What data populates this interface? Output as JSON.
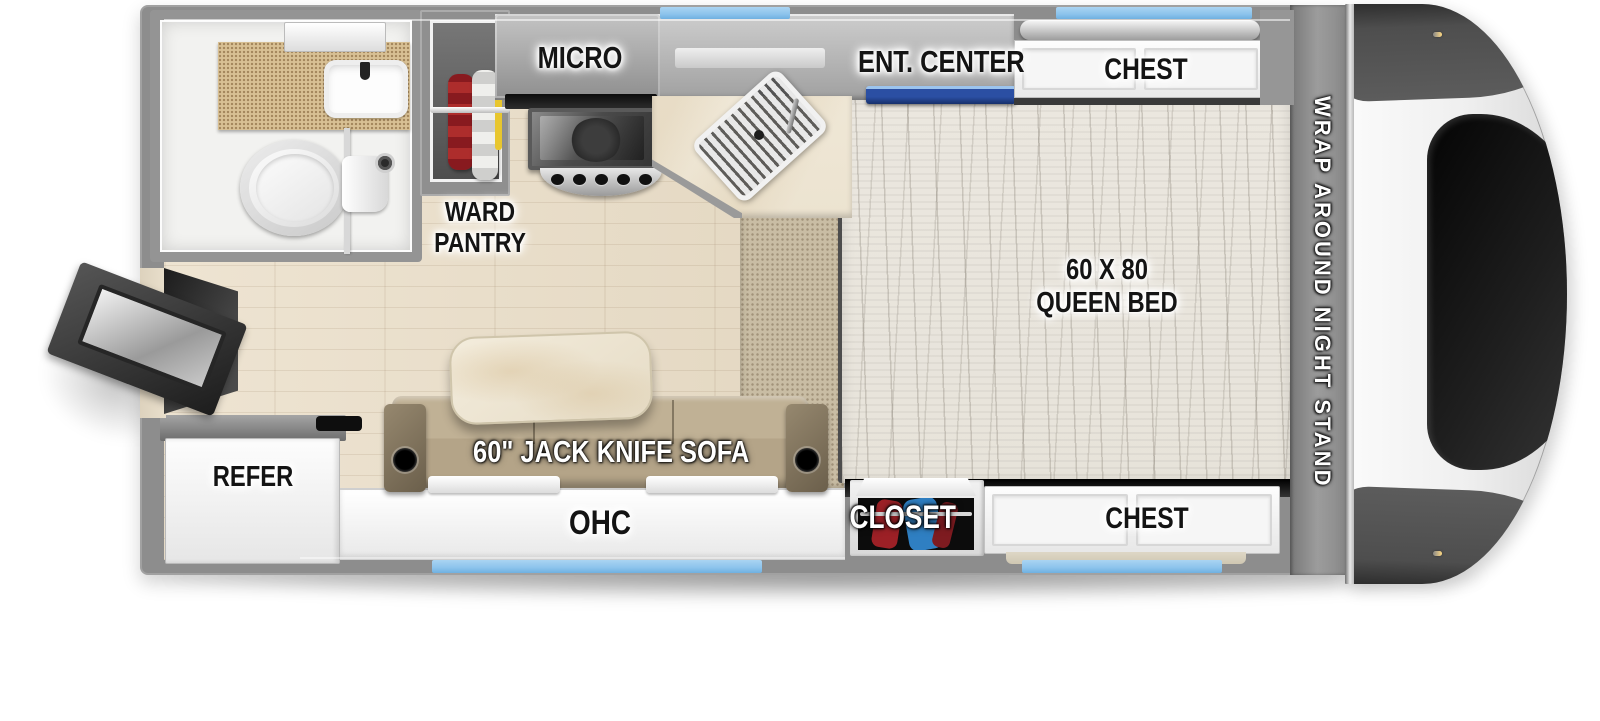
{
  "colors": {
    "window_blue": "#8cc3ec",
    "tv_blue": "#2b4fa3",
    "wall": "#8d8d8d",
    "floor_wood": "#e9dfcc",
    "carpet": "#c9bda4",
    "mattress": "#e7e3da",
    "sofa_tan": "#b4a488",
    "counter_cream": "#ece3d0",
    "bath_counter": "#d8c094",
    "clothes_red": "#9c2026",
    "clothes_blue": "#2f7fc2",
    "hanger_yellow": "#e8c62e",
    "label_dark": "#141414",
    "label_light": "#ffffff"
  },
  "labels": {
    "micro": "MICRO",
    "ent_center": "ENT. CENTER",
    "chest_top": "CHEST",
    "ward_line1": "WARD",
    "ward_line2": "PANTRY",
    "bed_line1": "60 X 80",
    "bed_line2": "QUEEN BED",
    "night_stand": "WRAP AROUND NIGHT STAND",
    "closet": "CLOSET",
    "chest_bottom": "CHEST",
    "refer": "REFER",
    "sofa": "60\" JACK KNIFE SOFA",
    "ohc": "OHC"
  }
}
